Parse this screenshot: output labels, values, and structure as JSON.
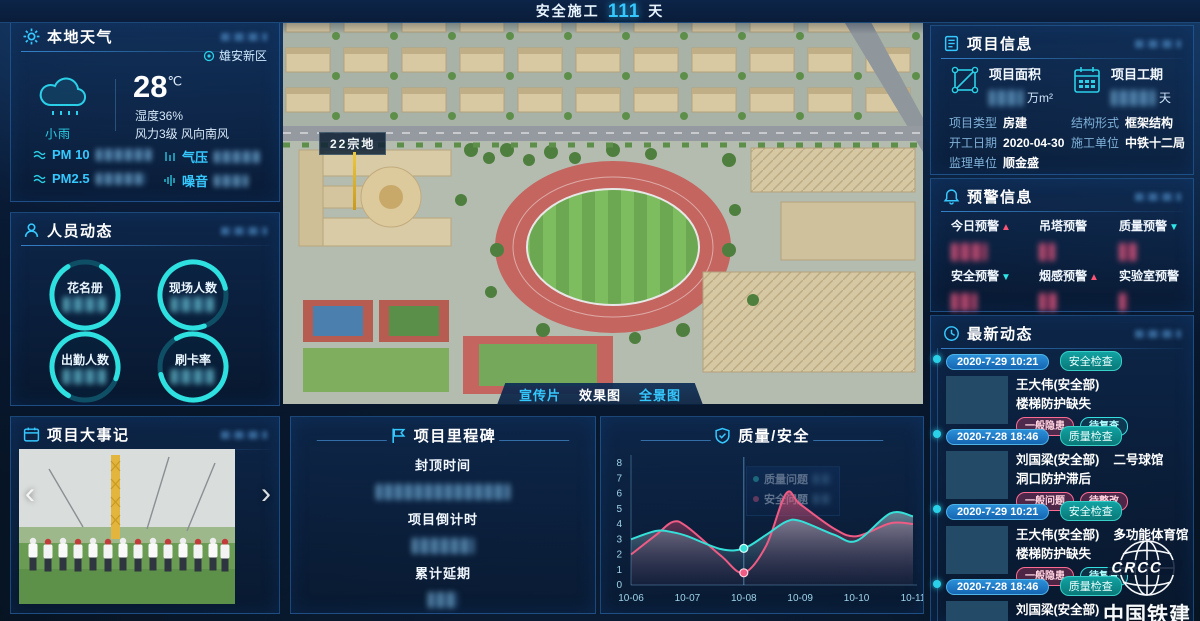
{
  "header": {
    "prefix": "安全施工",
    "days": "111",
    "suffix": "天"
  },
  "weather": {
    "title": "本地天气",
    "location": "雄安新区",
    "temp": "28",
    "temp_unit": "℃",
    "condition": "小雨",
    "humidity": "湿度36%",
    "wind": "风力3级 风向南风",
    "metrics": [
      {
        "label": "PM 10"
      },
      {
        "label": "气压"
      },
      {
        "label": "PM2.5"
      },
      {
        "label": "噪音"
      }
    ]
  },
  "personnel": {
    "title": "人员动态",
    "rings": [
      {
        "label": "花名册"
      },
      {
        "label": "现场人数"
      },
      {
        "label": "出勤人数"
      },
      {
        "label": "刷卡率"
      }
    ]
  },
  "events": {
    "title": "项目大事记",
    "prev": "‹",
    "next": "›"
  },
  "scene": {
    "land_label": "22宗地",
    "buttons": [
      {
        "label": "宣传片",
        "cls": ""
      },
      {
        "label": "效果图",
        "cls": "btn-active"
      },
      {
        "label": "全景图",
        "cls": ""
      }
    ]
  },
  "milestone": {
    "title": "项目里程碑",
    "items": [
      {
        "label": "封顶时间"
      },
      {
        "label": "项目倒计时"
      },
      {
        "label": "累计延期"
      }
    ]
  },
  "quality_panel": {
    "title": "质量/安全"
  },
  "chart_data": {
    "type": "area-line",
    "title": "质量/安全",
    "categories": [
      "10-06",
      "10-07",
      "10-08",
      "10-09",
      "10-10",
      "10-11"
    ],
    "ylim": [
      0,
      8
    ],
    "grid": false,
    "legend_position": "tooltip-center",
    "marker_index": 2,
    "x_fine": [
      0,
      0.45,
      0.75,
      1,
      1.6,
      2,
      2.4,
      2.75,
      3,
      3.6,
      4,
      4.6,
      5
    ],
    "series": [
      {
        "name": "质量问题",
        "color": "#35e0d8",
        "values": [
          3.0,
          3.2,
          2.4,
          4.2,
          2.9,
          4.5
        ],
        "fine": [
          3.0,
          3.55,
          3.45,
          3.2,
          2.35,
          2.4,
          3.3,
          4.15,
          4.2,
          3.3,
          2.9,
          4.7,
          4.5
        ]
      },
      {
        "name": "安全问题",
        "color": "#ef5b84",
        "values": [
          2.0,
          3.8,
          0.8,
          5.3,
          3.2,
          4.0
        ],
        "fine": [
          2.0,
          3.3,
          4.15,
          3.8,
          1.9,
          0.8,
          2.6,
          6.0,
          5.3,
          3.7,
          3.2,
          4.05,
          4.0
        ]
      }
    ]
  },
  "project": {
    "title": "项目信息",
    "stats": [
      {
        "label": "项目面积",
        "unit": "万m²"
      },
      {
        "label": "项目工期",
        "unit": "天"
      }
    ],
    "fields": [
      {
        "label": "项目类型",
        "value": "房建"
      },
      {
        "label": "结构形式",
        "value": "框架结构"
      },
      {
        "label": "开工日期",
        "value": "2020-04-30"
      },
      {
        "label": "施工单位",
        "value": "中铁十二局"
      },
      {
        "label": "监理单位",
        "value": "顺金盛"
      }
    ]
  },
  "warnings": {
    "title": "预警信息",
    "items": [
      {
        "label": "今日预警",
        "trend": "▲",
        "tcls": "up"
      },
      {
        "label": "吊塔预警",
        "trend": "",
        "tcls": ""
      },
      {
        "label": "质量预警",
        "trend": "▼",
        "tcls": "down"
      },
      {
        "label": "安全预警",
        "trend": "▼",
        "tcls": "down"
      },
      {
        "label": "烟感预警",
        "trend": "▲",
        "tcls": "up"
      },
      {
        "label": "实验室预警",
        "trend": "",
        "tcls": ""
      }
    ]
  },
  "updates": {
    "title": "最新动态",
    "items": [
      {
        "date": "2020-7-29 10:21",
        "type": "安全检查",
        "person": "王大伟(安全部)",
        "location": "",
        "issue": "楼梯防护缺失",
        "tags": [
          {
            "text": "一般隐患",
            "cls": "pink"
          },
          {
            "text": "待复查",
            "cls": "cyan"
          }
        ]
      },
      {
        "date": "2020-7-28 18:46",
        "type": "质量检查",
        "person": "刘国梁(安全部)",
        "location": "二号球馆",
        "issue": "洞口防护滞后",
        "tags": [
          {
            "text": "一般问题",
            "cls": "pink"
          },
          {
            "text": "待整改",
            "cls": "pink"
          }
        ]
      },
      {
        "date": "2020-7-29 10:21",
        "type": "安全检查",
        "person": "王大伟(安全部)",
        "location": "多功能体育馆",
        "issue": "楼梯防护缺失",
        "tags": [
          {
            "text": "一般隐患",
            "cls": "pink"
          },
          {
            "text": "待复查",
            "cls": "cyan"
          }
        ]
      },
      {
        "date": "2020-7-28 18:46",
        "type": "质量检查",
        "person": "刘国梁(安全部)",
        "location": "",
        "issue": "",
        "tags": []
      }
    ]
  },
  "logo": {
    "mark": "CRCC",
    "brand": "中国铁建"
  }
}
